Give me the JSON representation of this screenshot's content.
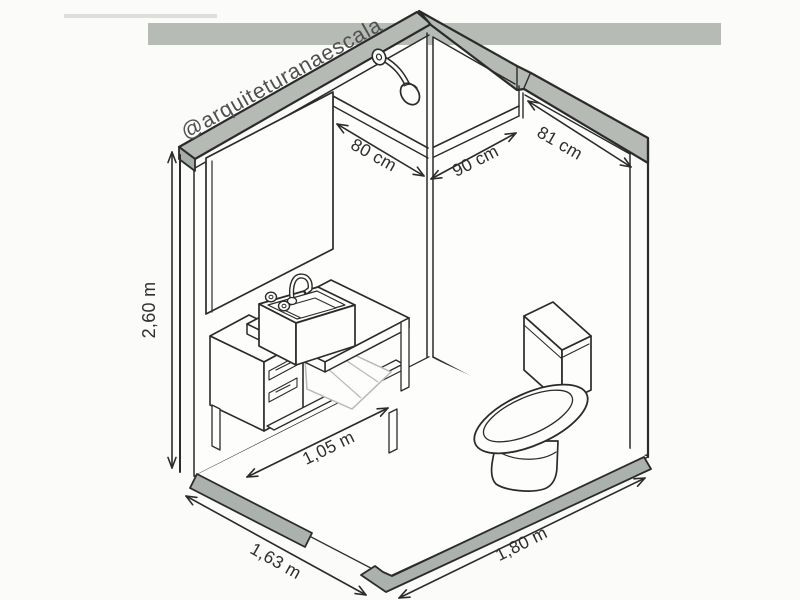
{
  "watermark": "@arquiteturanaescala",
  "dimensions": {
    "wall_height": "2,60 m",
    "shower_width_back_left": "80 cm",
    "shower_width_back_right": "90 cm",
    "right_wall_segment": "81 cm",
    "vanity_width": "1,05 m",
    "floor_edge_left": "1,63 m",
    "floor_edge_right": "1,80 m"
  },
  "fixtures": {
    "shower_head": "shower-head",
    "mirror": "mirror",
    "vanity": "vanity-cabinet-with-sink",
    "towel": "towel",
    "toilet": "toilet"
  },
  "colors": {
    "background": "#fbfbfa",
    "line": "#2b2b2b",
    "wall_cap_gray": "#b5bab5",
    "wall_cap_end_gray": "#a6aca7",
    "top_band_gray": "#b6bbb6",
    "baseboard_gray": "#abb1ac",
    "watermark_gray": "#4f4f4f",
    "towel_gray": "#b8b8b8"
  }
}
